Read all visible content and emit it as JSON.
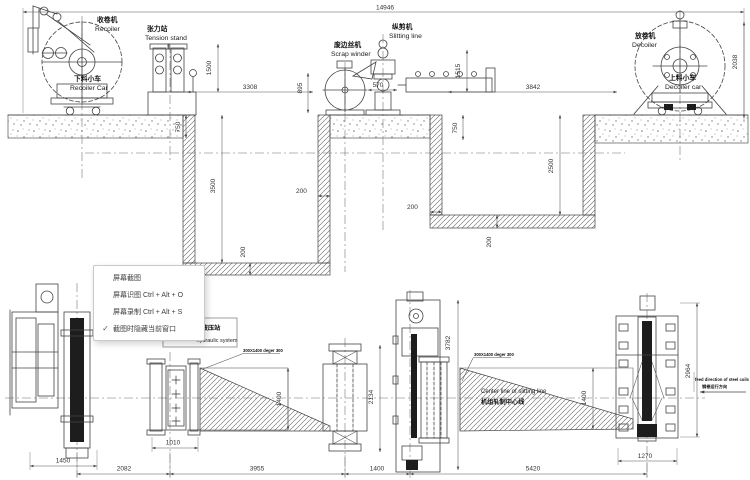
{
  "menu": {
    "check_glyph": "✓",
    "items": [
      {
        "label": "屏幕截图",
        "checked": false
      },
      {
        "label": "屏幕识图 Ctrl + Alt + O",
        "checked": false
      },
      {
        "label": "屏幕录制 Ctrl + Alt + S",
        "checked": false
      },
      {
        "label": "截图时隐藏当前窗口",
        "checked": true
      }
    ]
  },
  "drawing": {
    "labels": {
      "recoiler_zh": "收卷机",
      "recoiler_en": "Recoiler",
      "recoiler_car_zh": "下料小车",
      "recoiler_car_en": "Recoiler Car",
      "tension_zh": "张力站",
      "tension_en": "Tension stand",
      "scrap_zh": "废边丝机",
      "scrap_en": "Scrap winder",
      "slitting_zh": "纵剪机",
      "slitting_en": "Slitting line",
      "decoiler_zh": "放卷机",
      "decoiler_en": "Decoiler",
      "decoiler_car_zh": "上料小车",
      "decoiler_car_en": "Decoiler car",
      "hydraulic_zh": "液压站",
      "hydraulic_en": "hydraulic system",
      "centerline_en": "Center line of slitting line",
      "centerline_zh": "机组轧制中心线",
      "feed_en": "feed direction of steel coils",
      "feed_zh": "钢卷运行方向",
      "coil_note": "300X1400 deger 300"
    },
    "dims": {
      "total": "14946",
      "h2038": "2038",
      "h1500": "1500",
      "h3308": "3308",
      "h895": "895",
      "h570": "570",
      "h1515": "1515",
      "h3842": "3842",
      "p750l": "750",
      "p750r": "750",
      "p3500": "3500",
      "p2500": "2500",
      "w200a": "200",
      "w200b": "200",
      "w200c": "200",
      "w200d": "200",
      "b1450": "1450",
      "b2082": "2082",
      "b3955": "3955",
      "b1400": "1400",
      "b5420": "5420",
      "b1270": "1270",
      "b1010": "1010",
      "v2134": "2134",
      "v3782": "3782",
      "v1400l": "1400",
      "v1400r": "1400",
      "v2964": "2964"
    }
  }
}
